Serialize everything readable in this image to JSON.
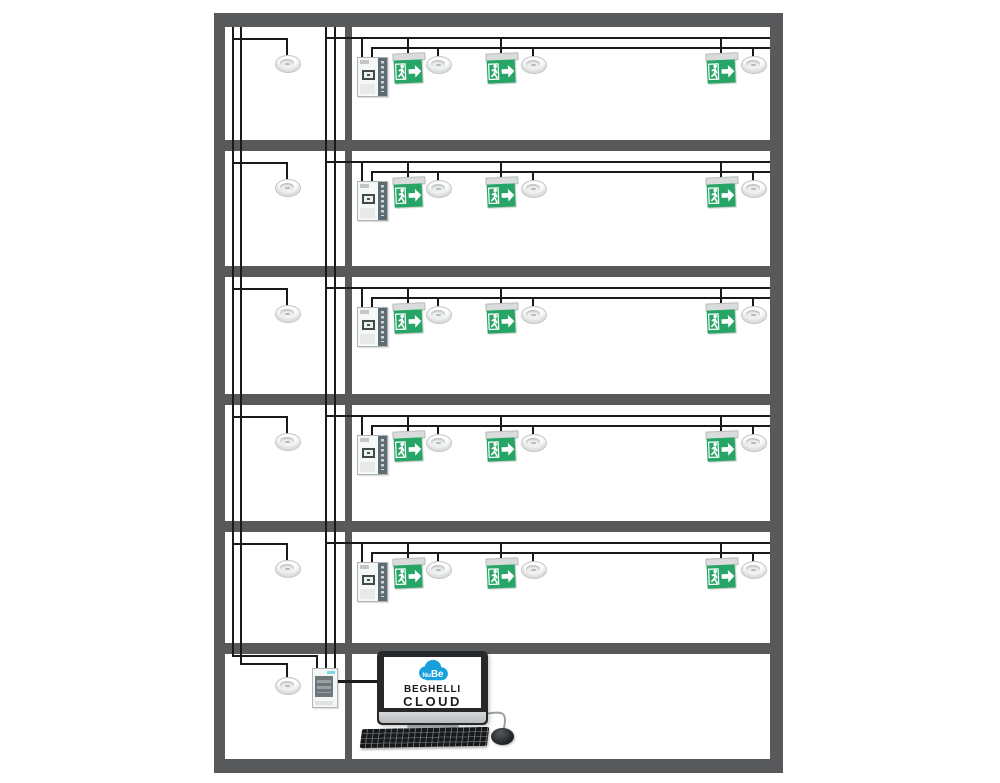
{
  "page": {
    "background": "#ffffff"
  },
  "colors": {
    "wall": "#58595b",
    "wire": "#1a1a1a",
    "exit_green": "#27a567",
    "sign_mount": "#d9dcda",
    "cloud_blue": "#18a0dc",
    "panel_dark": "#5d6b74",
    "cabinet_accent": "#7ed9e6",
    "monitor_bezel": "#26282a",
    "monitor_silver": "#c6c9cb"
  },
  "computer": {
    "logo": {
      "cloud_small": "Nu",
      "cloud_big": "Be",
      "brand": "BEGHELLI",
      "product": "CLOUD"
    }
  },
  "building": {
    "floors": [
      {
        "name": "floor-1",
        "top": 27,
        "corridor_downlight_cx": 287,
        "devices": [
          {
            "type": "control-panel",
            "cx": 371.5
          },
          {
            "type": "exit-sign",
            "cx": 408
          },
          {
            "type": "downlight",
            "cx": 438
          },
          {
            "type": "exit-sign",
            "cx": 501
          },
          {
            "type": "downlight",
            "cx": 533
          },
          {
            "type": "exit-sign",
            "cx": 721
          },
          {
            "type": "downlight",
            "cx": 753
          }
        ]
      },
      {
        "name": "floor-2",
        "top": 151,
        "corridor_downlight_cx": 287,
        "devices": [
          {
            "type": "control-panel",
            "cx": 371.5
          },
          {
            "type": "exit-sign",
            "cx": 408
          },
          {
            "type": "downlight",
            "cx": 438
          },
          {
            "type": "exit-sign",
            "cx": 501
          },
          {
            "type": "downlight",
            "cx": 533
          },
          {
            "type": "exit-sign",
            "cx": 721
          },
          {
            "type": "downlight",
            "cx": 753
          }
        ]
      },
      {
        "name": "floor-3",
        "top": 277,
        "corridor_downlight_cx": 287,
        "devices": [
          {
            "type": "control-panel",
            "cx": 371.5
          },
          {
            "type": "exit-sign",
            "cx": 408
          },
          {
            "type": "downlight",
            "cx": 438
          },
          {
            "type": "exit-sign",
            "cx": 501
          },
          {
            "type": "downlight",
            "cx": 533
          },
          {
            "type": "exit-sign",
            "cx": 721
          },
          {
            "type": "downlight",
            "cx": 753
          }
        ]
      },
      {
        "name": "floor-4",
        "top": 405,
        "corridor_downlight_cx": 287,
        "devices": [
          {
            "type": "control-panel",
            "cx": 371.5
          },
          {
            "type": "exit-sign",
            "cx": 408
          },
          {
            "type": "downlight",
            "cx": 438
          },
          {
            "type": "exit-sign",
            "cx": 501
          },
          {
            "type": "downlight",
            "cx": 533
          },
          {
            "type": "exit-sign",
            "cx": 721
          },
          {
            "type": "downlight",
            "cx": 753
          }
        ]
      },
      {
        "name": "floor-5",
        "top": 532,
        "corridor_downlight_cx": 287,
        "devices": [
          {
            "type": "control-panel",
            "cx": 371.5
          },
          {
            "type": "exit-sign",
            "cx": 408
          },
          {
            "type": "downlight",
            "cx": 438
          },
          {
            "type": "exit-sign",
            "cx": 501
          },
          {
            "type": "downlight",
            "cx": 533
          },
          {
            "type": "exit-sign",
            "cx": 721
          },
          {
            "type": "downlight",
            "cx": 753
          }
        ]
      }
    ],
    "ground_floor": {
      "name": "ground-floor",
      "top": 654,
      "corridor_downlight_cx": 287,
      "gateway_cabinet_cx": 324,
      "computer_present": true
    }
  }
}
